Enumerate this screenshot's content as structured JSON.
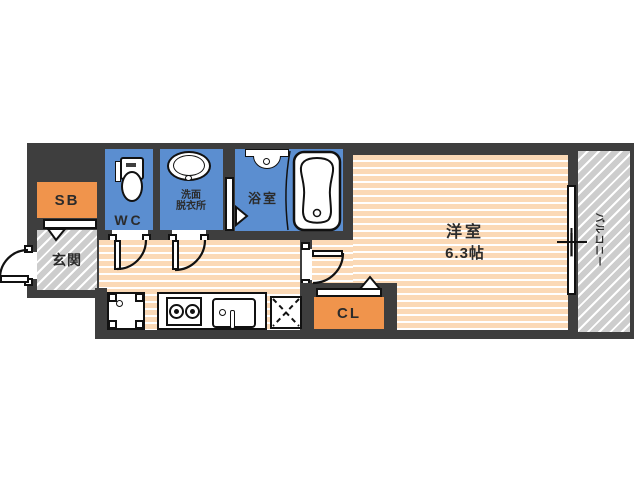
{
  "rooms": {
    "sb": {
      "label": "SB"
    },
    "genkan": {
      "label": "玄関"
    },
    "wc": {
      "label": "WC"
    },
    "washroom": {
      "label_line1": "洗面",
      "label_line2": "脱衣所"
    },
    "bathroom": {
      "label": "浴室"
    },
    "western_room": {
      "label": "洋室",
      "size": "6.3帖"
    },
    "closet": {
      "label": "CL"
    },
    "balcony": {
      "label": "バルコニー"
    }
  },
  "colors": {
    "wall": "#3e3e3e",
    "wet_area": "#5b8ed0",
    "storage": "#f0944c",
    "flooring": "#fbd9b6",
    "hatch": "#cdcdcd"
  }
}
